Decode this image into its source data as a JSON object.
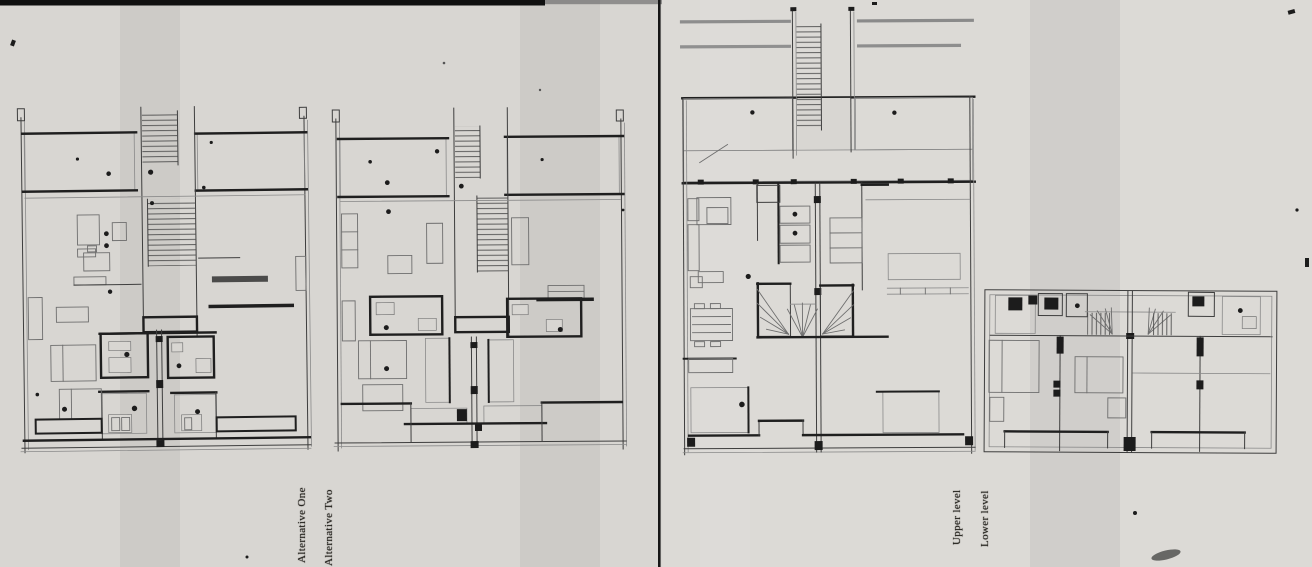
{
  "sheet": {
    "description": "Scanned architectural floor-plan drawings, two sheets side by side",
    "left_panel": {
      "plans": [
        {
          "id": "alternative-one",
          "label": "Alternative One"
        },
        {
          "id": "alternative-two",
          "label": "Alternative Two"
        }
      ]
    },
    "right_panel": {
      "plans": [
        {
          "id": "upper-level",
          "label": "Upper level"
        },
        {
          "id": "lower-level",
          "label": "Lower level"
        }
      ]
    }
  },
  "colors": {
    "paper": "#d8d6d2",
    "paper_right": "#dcdad6",
    "ink": "#3e3e3e",
    "ink_bold": "#1f1f1f",
    "grid_line": "#7d7d7d",
    "hatch_line": "#5a5a5a",
    "divider": "#161616",
    "top_strip": "#101010"
  }
}
